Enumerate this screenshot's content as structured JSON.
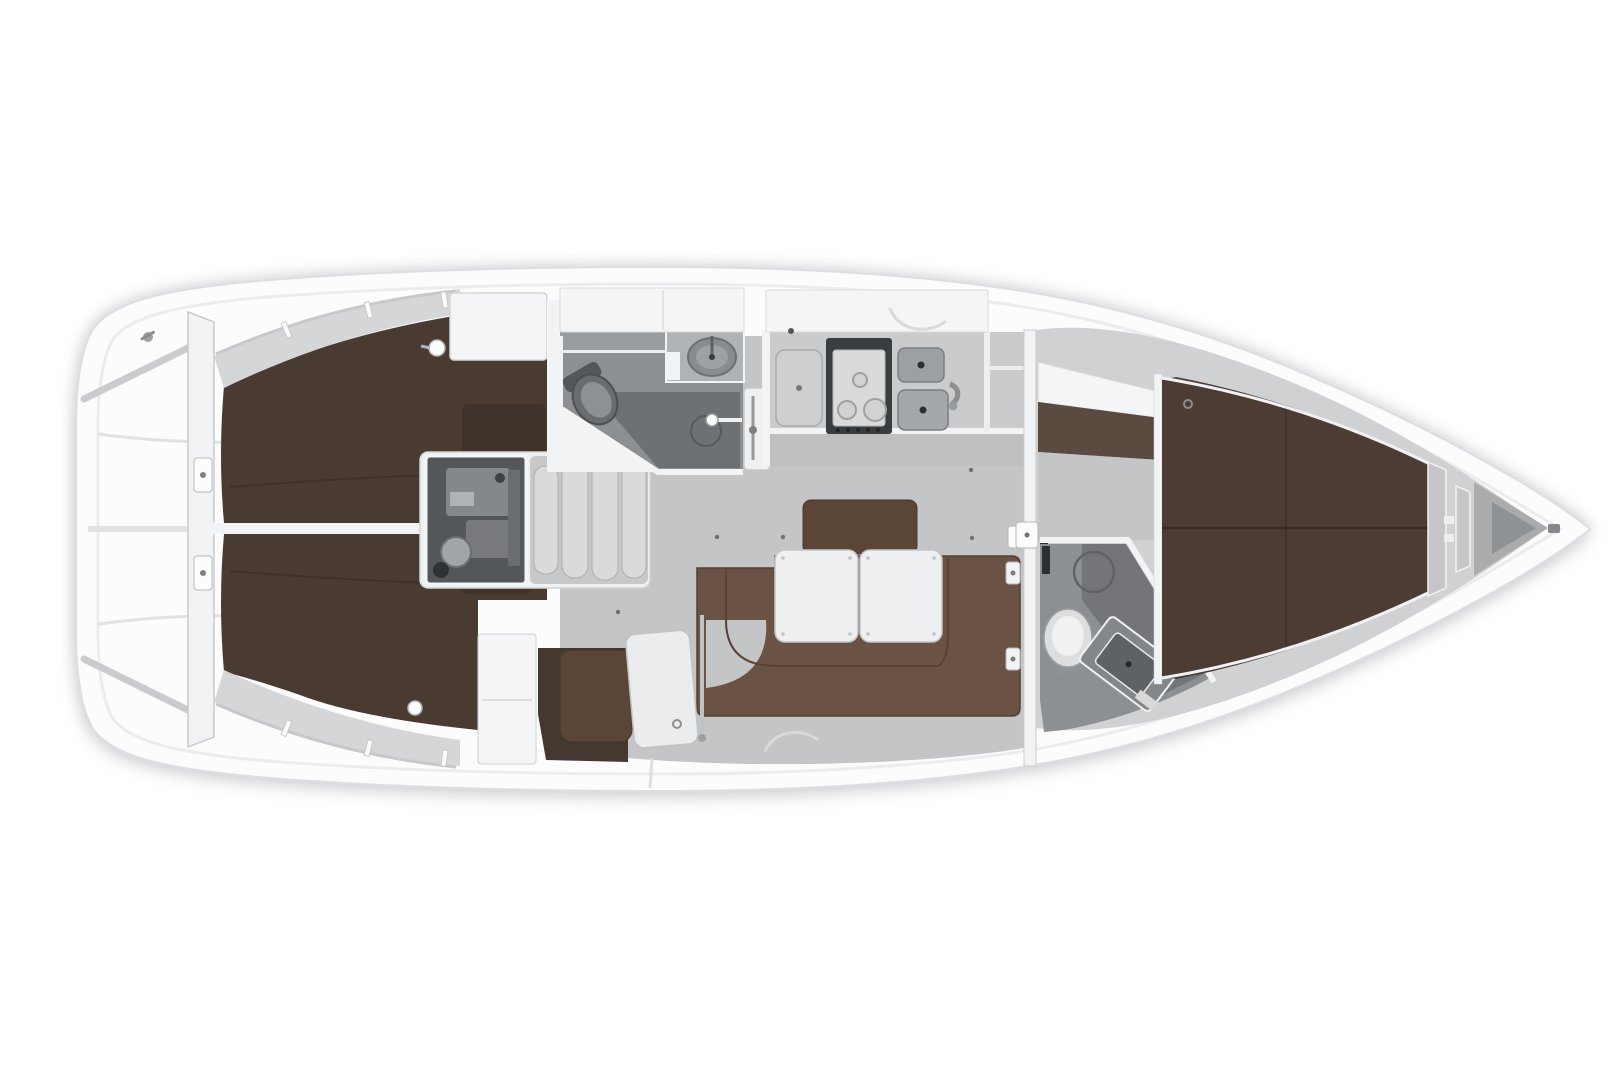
{
  "canvas": {
    "width": 1620,
    "height": 1080
  },
  "figure": {
    "kind": "sailing-yacht-interior-floor-plan",
    "view": "top-down",
    "bow_direction": "right"
  },
  "colors": {
    "page_bg": "#ffffff",
    "hull_white": "#fcfcfd",
    "hull_edge": "#dddee1",
    "rim_line": "#ececee",
    "deck_gray": "#cfd1d3",
    "shelf_gray": "#d5d6d8",
    "sole_gray": "#c3c5c7",
    "counter_gray": "#c9cbcd",
    "counter_front": "#bdbfc1",
    "heads_floor": "#8d9092",
    "shower_floor": "#6e7174",
    "engine_box": "#54575a",
    "engine_part": "#85888b",
    "steps_fill": "#d9dadc",
    "steps_well": "#c6c8ca",
    "cabin_brown": "#4a3b32",
    "cabin_inset_brown": "#3f322b",
    "berth_brown": "#4c3c33",
    "seam_brown": "#352a23",
    "dressing_brown": "#5a4a3f",
    "settee_brown": "#6a5244",
    "backrest_brown": "#5b4536",
    "nav_floor_brown": "#453830",
    "table_white": "#edeff0",
    "wall_white": "#f2f3f4",
    "locker_white": "#f4f5f6",
    "line_gray": "#c6c8ca",
    "fitting_gray": "#9da0a2",
    "dark_fitting": "#55585a",
    "sink_gray": "#9da0a3",
    "stove_dark": "#3a3d40",
    "stove_top": "#d8dadc",
    "toilet_white": "#dcdee0",
    "bow_locker": "#a9abad",
    "bow_inner": "#8f9294"
  },
  "components": {
    "hull": "hull",
    "stern_platform": "stern-swim-platform",
    "aft_bulkhead": "aft-bulkhead",
    "aft_cabin_port": "aft-cabin-port",
    "aft_cabin_starboard": "aft-cabin-starboard",
    "engine": "engine-compartment",
    "steps": "companionway-steps",
    "aft_heads": "aft-heads-with-shower",
    "galley": "galley",
    "salon": "salon",
    "settee": "u-shaped-settee",
    "tables": "twin-salon-tables",
    "nav_station": "nav-station",
    "mast_bulkhead": "mast-bulkhead",
    "forward_heads": "forward-heads",
    "forward_berth": "forward-v-berth",
    "anchor_locker": "bow-anchor-locker"
  }
}
